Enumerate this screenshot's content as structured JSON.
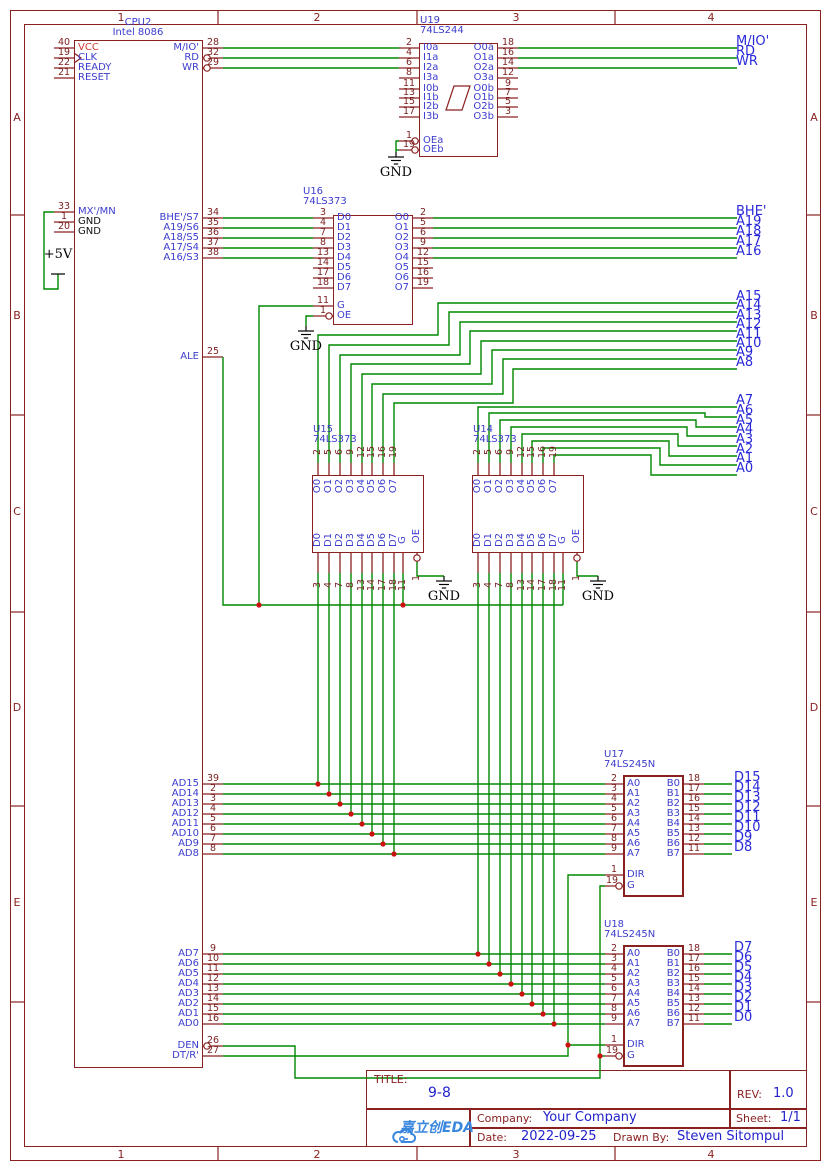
{
  "frame": {
    "columns": [
      "1",
      "2",
      "3",
      "4"
    ],
    "rows": [
      "A",
      "B",
      "C",
      "D",
      "E"
    ]
  },
  "title_block": {
    "title_label": "TITLE:",
    "title": "9-8",
    "rev_label": "REV:",
    "rev": "1.0",
    "company_label": "Company:",
    "company": "Your Company",
    "sheet_label": "Sheet:",
    "sheet": "1/1",
    "date_label": "Date:",
    "date": "2022-09-25",
    "drawn_by_label": "Drawn By:",
    "drawn_by": "Steven Sitompul",
    "logo_text": "嘉立创EDA"
  },
  "power": {
    "gnd": "GND",
    "vcc": "+5V"
  },
  "colors": {
    "wire": "#008800",
    "outline": "#8a2121",
    "net_label": "#2929d8",
    "pin_name": "#3c3ccd",
    "pin_number": "#7a1f1f",
    "junction": "#cc1111",
    "logo": "#3a87de",
    "title_value": "#2222cc",
    "vcc_name": "#d63838"
  },
  "components": {
    "cpu": {
      "ref": "CPU2",
      "value": "Intel 8086",
      "left_pins": [
        {
          "num": "40",
          "name": "VCC"
        },
        {
          "num": "19",
          "name": "CLK"
        },
        {
          "num": "22",
          "name": "READY"
        },
        {
          "num": "21",
          "name": "RESET"
        },
        {
          "num": "33",
          "name": "MX'/MN"
        },
        {
          "num": "1",
          "name": "GND"
        },
        {
          "num": "20",
          "name": "GND"
        }
      ],
      "right_pins": [
        {
          "num": "28",
          "name": "M/IO'"
        },
        {
          "num": "32",
          "name": "RD"
        },
        {
          "num": "29",
          "name": "WR"
        },
        {
          "num": "34",
          "name": "BHE'/S7"
        },
        {
          "num": "35",
          "name": "A19/S6"
        },
        {
          "num": "36",
          "name": "A18/S5"
        },
        {
          "num": "37",
          "name": "A17/S4"
        },
        {
          "num": "38",
          "name": "A16/S3"
        },
        {
          "num": "25",
          "name": "ALE"
        },
        {
          "num": "39",
          "name": "AD15"
        },
        {
          "num": "2",
          "name": "AD14"
        },
        {
          "num": "3",
          "name": "AD13"
        },
        {
          "num": "4",
          "name": "AD12"
        },
        {
          "num": "5",
          "name": "AD11"
        },
        {
          "num": "6",
          "name": "AD10"
        },
        {
          "num": "7",
          "name": "AD9"
        },
        {
          "num": "8",
          "name": "AD8"
        },
        {
          "num": "9",
          "name": "AD7"
        },
        {
          "num": "10",
          "name": "AD6"
        },
        {
          "num": "11",
          "name": "AD5"
        },
        {
          "num": "12",
          "name": "AD4"
        },
        {
          "num": "13",
          "name": "AD3"
        },
        {
          "num": "14",
          "name": "AD2"
        },
        {
          "num": "15",
          "name": "AD1"
        },
        {
          "num": "16",
          "name": "AD0"
        },
        {
          "num": "26",
          "name": "DEN"
        },
        {
          "num": "27",
          "name": "DT/R'"
        }
      ]
    },
    "u19": {
      "ref": "U19",
      "value": "74LS244",
      "left_pins": [
        {
          "num": "2",
          "name": "I0a"
        },
        {
          "num": "4",
          "name": "I1a"
        },
        {
          "num": "6",
          "name": "I2a"
        },
        {
          "num": "8",
          "name": "I3a"
        },
        {
          "num": "11",
          "name": "I0b"
        },
        {
          "num": "13",
          "name": "I1b"
        },
        {
          "num": "15",
          "name": "I2b"
        },
        {
          "num": "17",
          "name": "I3b"
        },
        {
          "num": "1",
          "name": "OEa"
        },
        {
          "num": "19",
          "name": "OEb"
        }
      ],
      "right_pins": [
        {
          "num": "18",
          "name": "O0a"
        },
        {
          "num": "16",
          "name": "O1a"
        },
        {
          "num": "14",
          "name": "O2a"
        },
        {
          "num": "12",
          "name": "O3a"
        },
        {
          "num": "9",
          "name": "O0b"
        },
        {
          "num": "7",
          "name": "O1b"
        },
        {
          "num": "5",
          "name": "O2b"
        },
        {
          "num": "3",
          "name": "O3b"
        }
      ]
    },
    "u16": {
      "ref": "U16",
      "value": "74LS373",
      "left_pins": [
        {
          "num": "3",
          "name": "D0"
        },
        {
          "num": "4",
          "name": "D1"
        },
        {
          "num": "7",
          "name": "D2"
        },
        {
          "num": "8",
          "name": "D3"
        },
        {
          "num": "13",
          "name": "D4"
        },
        {
          "num": "14",
          "name": "D5"
        },
        {
          "num": "17",
          "name": "D6"
        },
        {
          "num": "18",
          "name": "D7"
        },
        {
          "num": "11",
          "name": "G"
        },
        {
          "num": "1",
          "name": "OE"
        }
      ],
      "right_pins": [
        {
          "num": "2",
          "name": "O0"
        },
        {
          "num": "5",
          "name": "O1"
        },
        {
          "num": "6",
          "name": "O2"
        },
        {
          "num": "9",
          "name": "O3"
        },
        {
          "num": "12",
          "name": "O4"
        },
        {
          "num": "15",
          "name": "O5"
        },
        {
          "num": "16",
          "name": "O6"
        },
        {
          "num": "19",
          "name": "O7"
        }
      ]
    },
    "u15": {
      "ref": "U15",
      "value": "74LS373",
      "top_pins": [
        {
          "num": "2",
          "name": "O0"
        },
        {
          "num": "5",
          "name": "O1"
        },
        {
          "num": "6",
          "name": "O2"
        },
        {
          "num": "9",
          "name": "O3"
        },
        {
          "num": "12",
          "name": "O4"
        },
        {
          "num": "15",
          "name": "O5"
        },
        {
          "num": "16",
          "name": "O6"
        },
        {
          "num": "19",
          "name": "O7"
        }
      ],
      "bottom_pins": [
        {
          "num": "3",
          "name": "D0"
        },
        {
          "num": "4",
          "name": "D1"
        },
        {
          "num": "7",
          "name": "D2"
        },
        {
          "num": "8",
          "name": "D3"
        },
        {
          "num": "13",
          "name": "D4"
        },
        {
          "num": "14",
          "name": "D5"
        },
        {
          "num": "17",
          "name": "D6"
        },
        {
          "num": "18",
          "name": "D7"
        }
      ],
      "g": {
        "num": "11",
        "name": "G"
      },
      "oe": {
        "num": "1",
        "name": "OE"
      }
    },
    "u14": {
      "ref": "U14",
      "value": "74LS373",
      "top_pins": [
        {
          "num": "2",
          "name": "O0"
        },
        {
          "num": "5",
          "name": "O1"
        },
        {
          "num": "6",
          "name": "O2"
        },
        {
          "num": "9",
          "name": "O3"
        },
        {
          "num": "12",
          "name": "O4"
        },
        {
          "num": "15",
          "name": "O5"
        },
        {
          "num": "16",
          "name": "O6"
        },
        {
          "num": "19",
          "name": "O7"
        }
      ],
      "bottom_pins": [
        {
          "num": "3",
          "name": "D0"
        },
        {
          "num": "4",
          "name": "D1"
        },
        {
          "num": "7",
          "name": "D2"
        },
        {
          "num": "8",
          "name": "D3"
        },
        {
          "num": "13",
          "name": "D4"
        },
        {
          "num": "14",
          "name": "D5"
        },
        {
          "num": "17",
          "name": "D6"
        },
        {
          "num": "18",
          "name": "D7"
        }
      ],
      "g": {
        "num": "11",
        "name": "G"
      },
      "oe": {
        "num": "1",
        "name": "OE"
      }
    },
    "u17": {
      "ref": "U17",
      "value": "74LS245N",
      "left_pins": [
        {
          "num": "2",
          "name": "A0"
        },
        {
          "num": "3",
          "name": "A1"
        },
        {
          "num": "4",
          "name": "A2"
        },
        {
          "num": "5",
          "name": "A3"
        },
        {
          "num": "6",
          "name": "A4"
        },
        {
          "num": "7",
          "name": "A5"
        },
        {
          "num": "8",
          "name": "A6"
        },
        {
          "num": "9",
          "name": "A7"
        }
      ],
      "right_pins": [
        {
          "num": "18",
          "name": "B0"
        },
        {
          "num": "17",
          "name": "B1"
        },
        {
          "num": "16",
          "name": "B2"
        },
        {
          "num": "15",
          "name": "B3"
        },
        {
          "num": "14",
          "name": "B4"
        },
        {
          "num": "13",
          "name": "B5"
        },
        {
          "num": "12",
          "name": "B6"
        },
        {
          "num": "11",
          "name": "B7"
        }
      ],
      "dir": {
        "num": "1",
        "name": "DIR"
      },
      "g": {
        "num": "19",
        "name": "G"
      }
    },
    "u18": {
      "ref": "U18",
      "value": "74LS245N",
      "left_pins": [
        {
          "num": "2",
          "name": "A0"
        },
        {
          "num": "3",
          "name": "A1"
        },
        {
          "num": "4",
          "name": "A2"
        },
        {
          "num": "5",
          "name": "A3"
        },
        {
          "num": "6",
          "name": "A4"
        },
        {
          "num": "7",
          "name": "A5"
        },
        {
          "num": "8",
          "name": "A6"
        },
        {
          "num": "9",
          "name": "A7"
        }
      ],
      "right_pins": [
        {
          "num": "18",
          "name": "B0"
        },
        {
          "num": "17",
          "name": "B1"
        },
        {
          "num": "16",
          "name": "B2"
        },
        {
          "num": "15",
          "name": "B3"
        },
        {
          "num": "14",
          "name": "B4"
        },
        {
          "num": "13",
          "name": "B5"
        },
        {
          "num": "12",
          "name": "B6"
        },
        {
          "num": "11",
          "name": "B7"
        }
      ],
      "dir": {
        "num": "1",
        "name": "DIR"
      },
      "g": {
        "num": "19",
        "name": "G"
      }
    }
  },
  "net_labels": {
    "control": [
      "M/IO'",
      "RD",
      "WR"
    ],
    "addr_high": [
      "BHE'",
      "A19",
      "A18",
      "A17",
      "A16"
    ],
    "addr_mid": [
      "A15",
      "A14",
      "A13",
      "A12",
      "A11",
      "A10",
      "A9",
      "A8"
    ],
    "addr_low": [
      "A7",
      "A6",
      "A5",
      "A4",
      "A3",
      "A2",
      "A1",
      "A0"
    ],
    "data_high": [
      "D15",
      "D14",
      "D13",
      "D12",
      "D11",
      "D10",
      "D9",
      "D8"
    ],
    "data_low": [
      "D7",
      "D6",
      "D5",
      "D4",
      "D3",
      "D2",
      "D1",
      "D0"
    ]
  }
}
